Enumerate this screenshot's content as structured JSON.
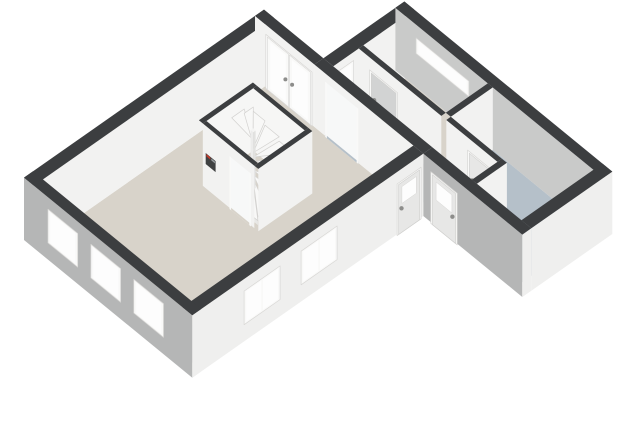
{
  "view": {
    "description": "isometric 3d floorplan render, ground floor, no visible text",
    "background": "#ffffff",
    "width": 640,
    "height": 430
  },
  "scene": {
    "wall_height": 2.6,
    "projection": {
      "origin": [
        24,
        240
      ],
      "e": [
        30,
        -21
      ],
      "s": [
        33,
        27
      ],
      "zpm": 24
    },
    "colors": {
      "cap": "#3c3e40",
      "int": "#f2f2f1",
      "int2": "#f6f6f5",
      "ext_w": "#b5b6b6",
      "ext_s": "#efefee",
      "ne_in": "#c9cac9",
      "beige": "#d8d3ca",
      "blue": "#b5c0c9",
      "frame": "#f9f9f8",
      "frame_edge": "#d8d7d5",
      "glass": "#fdfdfd",
      "leaf": "#e7e7e6",
      "leaf_gray": "#d2d3d3",
      "step": "#f8f8f7",
      "step_edge": "#d3d2d0",
      "riser": "#e8e8e6",
      "open": "#f7f8f8",
      "thresh": "#fafaf9",
      "meter": "#3f4142",
      "meter_red": "#c0392b",
      "basin_top": "#ffffff",
      "basin_s": "#f4f4f3",
      "basin_w": "#e9e9e8",
      "handle": "#8d8d8b",
      "knob": "#60625f"
    },
    "elements": [
      {
        "kind": "floor",
        "id": "living-room-floor",
        "pts": [
          [
            0.3,
            0.3
          ],
          [
            7.7,
            0.3
          ],
          [
            7.7,
            4.8
          ],
          [
            0.3,
            4.8
          ]
        ],
        "color": "beige"
      },
      {
        "kind": "floor",
        "id": "staircase-floor",
        "pts": [
          [
            4.52,
            1.42
          ],
          [
            6.08,
            1.42
          ],
          [
            6.08,
            2.98
          ],
          [
            4.52,
            2.98
          ]
        ],
        "color": "beige"
      },
      {
        "kind": "floor",
        "id": "hallway-floor",
        "pts": [
          [
            8.0,
            2.1
          ],
          [
            8.85,
            2.1
          ],
          [
            8.85,
            6.3
          ],
          [
            8.0,
            6.3
          ]
        ],
        "color": "blue"
      },
      {
        "kind": "floor",
        "id": "bedroom-floor",
        "pts": [
          [
            9.0,
            2.1
          ],
          [
            10.4,
            2.1
          ],
          [
            10.4,
            4.6
          ],
          [
            9.0,
            4.6
          ]
        ],
        "color": "beige"
      },
      {
        "kind": "floor",
        "id": "bathroom-floor",
        "pts": [
          [
            9.0,
            4.75
          ],
          [
            10.4,
            4.75
          ],
          [
            10.4,
            7.8
          ],
          [
            8.0,
            7.8
          ],
          [
            8.0,
            6.45
          ],
          [
            9.0,
            6.45
          ]
        ],
        "color": "blue"
      },
      {
        "kind": "threshold",
        "id": "hall-opening-threshold",
        "rect": [
          7.68,
          2.17,
          8.02,
          3.13
        ],
        "color": "thresh"
      },
      {
        "kind": "threshold",
        "id": "front-door-mat",
        "rect": [
          8.02,
          5.38,
          8.5,
          6.12
        ],
        "color": "thresh"
      },
      {
        "kind": "threshold",
        "id": "bathroom-door-threshold",
        "rect": [
          8.83,
          5.45,
          9.02,
          6.17
        ],
        "color": "thresh"
      },
      {
        "kind": "threshold",
        "id": "stair-door-threshold",
        "rect": [
          4.38,
          2.27,
          4.54,
          2.88
        ],
        "color": "thresh"
      },
      {
        "kind": "wall",
        "id": "wall-main-northwest",
        "rect": [
          0,
          0,
          8.0,
          0.3
        ],
        "faces": {
          "S": "int",
          "top": "cap"
        }
      },
      {
        "kind": "wall",
        "id": "wall-main-northeast-garden",
        "rect": [
          7.7,
          0,
          8.0,
          1.8
        ],
        "faces": {
          "W": "int",
          "top": "cap"
        },
        "openings": [
          {
            "type": "french",
            "face": "W",
            "u": [
              0.35,
              1.75
            ],
            "z": [
              0,
              2.25
            ],
            "name": "french-doors"
          }
        ]
      },
      {
        "kind": "wall",
        "id": "wall-wing-northwest",
        "rect": [
          8.0,
          1.8,
          10.7,
          2.1
        ],
        "faces": {
          "W": "ext_w",
          "S": "int",
          "top": "cap"
        },
        "openings": [
          {
            "type": "window",
            "face": "S",
            "u": [
              8.15,
              8.65
            ],
            "z": [
              0.25,
              2.3
            ],
            "name": "hall-tall-window"
          }
        ]
      },
      {
        "kind": "wall",
        "id": "wall-wing-northeast",
        "rect": [
          10.4,
          1.8,
          10.7,
          8.1
        ],
        "faces": {
          "W": "ne_in",
          "top": "cap"
        },
        "openings": [
          {
            "type": "window",
            "face": "W",
            "u": [
              2.45,
              4.05
            ],
            "z": [
              1.45,
              2.1
            ],
            "name": "bedroom-ribbon-window"
          }
        ]
      },
      {
        "kind": "wall",
        "id": "wall-bedroom-west",
        "rect": [
          8.85,
          2.1,
          9.0,
          4.6
        ],
        "faces": {
          "W": "int",
          "top": "cap"
        },
        "openings": [
          {
            "type": "door",
            "face": "W",
            "u": [
              2.45,
              3.3
            ],
            "z": [
              0,
              2.12
            ],
            "leaf": "leaf_gray",
            "handle": "near",
            "name": "bedroom-door"
          }
        ]
      },
      {
        "kind": "wall",
        "id": "wall-bedroom-bathroom-divider",
        "rect": [
          9.0,
          4.6,
          10.4,
          4.75
        ],
        "faces": {
          "S": "int",
          "top": "cap"
        }
      },
      {
        "kind": "wall",
        "id": "washbasin-unit",
        "rect": [
          9.2,
          4.95,
          9.62,
          5.32
        ],
        "h": 0.92,
        "faces": {
          "W": "basin_w",
          "S": "basin_s",
          "top": "basin_top"
        }
      },
      {
        "kind": "dot",
        "id": "washbasin-knob-left",
        "at": [
          9.31,
          5.34,
          0.72
        ],
        "r": 2.2,
        "color": "knob"
      },
      {
        "kind": "dot",
        "id": "washbasin-knob-right",
        "at": [
          9.47,
          5.34,
          0.72
        ],
        "r": 2.2,
        "color": "knob"
      },
      {
        "kind": "wall",
        "id": "wall-bathroom-west",
        "rect": [
          8.85,
          4.75,
          9.0,
          6.3
        ],
        "faces": {
          "W": "int",
          "top": "cap"
        },
        "openings": [
          {
            "type": "door",
            "face": "W",
            "u": [
              5.42,
              6.2
            ],
            "z": [
              0,
              2.12
            ],
            "handle": "near",
            "name": "bathroom-door"
          }
        ]
      },
      {
        "kind": "wall",
        "id": "wall-hallway-south",
        "rect": [
          8.0,
          6.3,
          9.0,
          6.45
        ],
        "faces": {
          "S": "int",
          "top": "cap"
        }
      },
      {
        "kind": "wall",
        "id": "wall-living-hall-divider",
        "rect": [
          7.7,
          1.8,
          8.0,
          5.1
        ],
        "faces": {
          "W": "int",
          "top": "cap"
        },
        "openings": [
          {
            "type": "opening",
            "face": "W",
            "u": [
              2.15,
              3.15
            ],
            "z": [
              0,
              2.3
            ],
            "floor": "blue",
            "name": "hall-opening"
          }
        ]
      },
      {
        "kind": "wall",
        "id": "wall-stairbox-north",
        "rect": [
          4.4,
          1.3,
          6.2,
          1.42
        ],
        "faces": {
          "S": "int2",
          "top": "cap"
        }
      },
      {
        "kind": "wall",
        "id": "wall-stairbox-east",
        "rect": [
          6.08,
          1.42,
          6.2,
          2.98
        ],
        "faces": {
          "W": "int2",
          "top": "cap"
        }
      },
      {
        "kind": "stairs",
        "id": "staircase",
        "newel": [
          5.26,
          2.16
        ],
        "box": [
          4.52,
          1.42,
          6.08,
          2.98
        ],
        "deg0": 155,
        "deg1": -85,
        "n": 11,
        "r": 1.15,
        "z0": 0.2,
        "dz": 0.18,
        "riser_deg": [
          45,
          235
        ]
      },
      {
        "kind": "wall",
        "id": "stair-newel-post",
        "rect": [
          5.22,
          2.12,
          5.3,
          2.2
        ],
        "h": 2.4,
        "faces": {
          "W": "#ececeb",
          "S": "#e2e2e0",
          "top": "#f4f4f3"
        }
      },
      {
        "kind": "wall",
        "id": "wall-stairbox-south",
        "rect": [
          4.4,
          2.98,
          6.2,
          3.1
        ],
        "faces": {
          "S": "int",
          "top": "cap"
        }
      },
      {
        "kind": "wall",
        "id": "wall-stairbox-west",
        "rect": [
          4.4,
          1.42,
          4.52,
          2.98
        ],
        "faces": {
          "W": "int",
          "top": "cap"
        },
        "openings": [
          {
            "type": "opening",
            "face": "W",
            "u": [
              2.25,
              2.9
            ],
            "z": [
              0,
              2.2
            ],
            "floor": "beige",
            "name": "stair-door-opening"
          }
        ]
      },
      {
        "kind": "panel",
        "id": "meter-box",
        "plane": "W",
        "x": 4.385,
        "u": [
          1.52,
          1.82
        ],
        "z": [
          1.04,
          1.5
        ],
        "color": "meter",
        "details": [
          {
            "u": [
              1.54,
              1.66
            ],
            "z": [
              1.38,
              1.48
            ],
            "color": "meter_red"
          },
          {
            "u": [
              1.69,
              1.8
            ],
            "z": [
              1.38,
              1.46
            ],
            "color": "#9aa0a3"
          }
        ]
      },
      {
        "kind": "wall",
        "id": "wall-wing-southwest",
        "rect": [
          7.7,
          5.1,
          8.0,
          8.1
        ],
        "faces": {
          "W": "ext_w",
          "S": "ext_s",
          "top": "cap"
        },
        "openings": [
          {
            "type": "door",
            "face": "W",
            "u": [
              5.35,
              6.15
            ],
            "z": [
              0,
              2.15
            ],
            "glass": [
              1.15,
              1.9
            ],
            "handle": "far",
            "name": "front-door"
          }
        ]
      },
      {
        "kind": "wall",
        "id": "wall-wing-south",
        "rect": [
          8.0,
          7.8,
          10.7,
          8.1
        ],
        "faces": {
          "S": "ext_s",
          "top": "cap"
        }
      },
      {
        "kind": "wall",
        "id": "wall-main-southeast",
        "rect": [
          0,
          4.8,
          7.7,
          5.1
        ],
        "faces": {
          "S": "ext_s",
          "top": "cap"
        },
        "openings": [
          {
            "type": "window",
            "face": "S",
            "u": [
              1.7,
              2.9
            ],
            "z": [
              0.75,
              2.15
            ],
            "mullion": true,
            "name": "living-window-se-1"
          },
          {
            "type": "window",
            "face": "S",
            "u": [
              3.6,
              4.8
            ],
            "z": [
              0.75,
              2.15
            ],
            "mullion": true,
            "name": "living-window-se-2"
          },
          {
            "type": "door",
            "face": "S",
            "u": [
              6.8,
              7.6
            ],
            "z": [
              0,
              2.15
            ],
            "glass": [
              1.2,
              1.9
            ],
            "handle": "near",
            "name": "side-door"
          }
        ]
      },
      {
        "kind": "wall",
        "id": "wall-main-southwest",
        "rect": [
          0,
          0,
          0.3,
          5.1
        ],
        "faces": {
          "W": "ext_w",
          "S": "ext_s",
          "top": "cap"
        },
        "openings": [
          {
            "type": "window",
            "face": "W",
            "u": [
              0.75,
              1.65
            ],
            "z": [
              0.75,
              2.15
            ],
            "name": "living-window-sw-1"
          },
          {
            "type": "window",
            "face": "W",
            "u": [
              2.05,
              2.95
            ],
            "z": [
              0.75,
              2.15
            ],
            "name": "living-window-sw-2"
          },
          {
            "type": "window",
            "face": "W",
            "u": [
              3.35,
              4.25
            ],
            "z": [
              0.75,
              2.15
            ],
            "name": "living-window-sw-3"
          }
        ]
      }
    ]
  }
}
